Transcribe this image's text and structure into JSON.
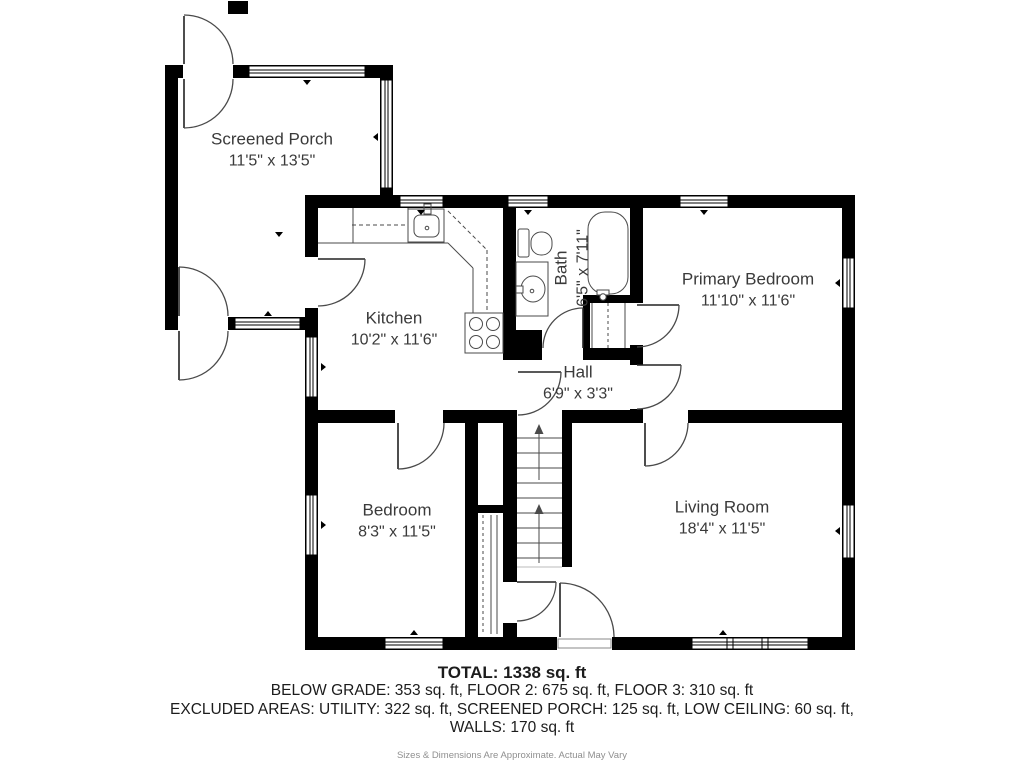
{
  "floorplan": {
    "rooms": [
      {
        "id": "screened-porch",
        "name": "Screened Porch",
        "dims": "11'5\" x 13'5\""
      },
      {
        "id": "kitchen",
        "name": "Kitchen",
        "dims": "10'2\" x 11'6\""
      },
      {
        "id": "bath",
        "name": "Bath",
        "dims": "6'5\" x 7'11\""
      },
      {
        "id": "primary-bedroom",
        "name": "Primary Bedroom",
        "dims": "11'10\" x 11'6\""
      },
      {
        "id": "hall",
        "name": "Hall",
        "dims": "6'9\" x 3'3\""
      },
      {
        "id": "bedroom",
        "name": "Bedroom",
        "dims": "8'3\" x 11'5\""
      },
      {
        "id": "living-room",
        "name": "Living Room",
        "dims": "18'4\" x 11'5\""
      }
    ],
    "summary": {
      "total": "TOTAL: 1338 sq. ft",
      "line2": "BELOW GRADE: 353 sq. ft, FLOOR 2: 675 sq. ft, FLOOR 3: 310 sq. ft",
      "line3": "EXCLUDED AREAS: UTILITY: 322 sq. ft, SCREENED PORCH: 125 sq. ft, LOW CEILING: 60 sq. ft,",
      "line4": "WALLS: 170 sq. ft",
      "disclaimer": "Sizes & Dimensions Are Approximate. Actual May Vary"
    },
    "colors": {
      "wall": "#000000",
      "fixture_line": "#4a4a4a",
      "room_text": "#3a3a3a",
      "muted_text": "#8f8f8f"
    }
  }
}
